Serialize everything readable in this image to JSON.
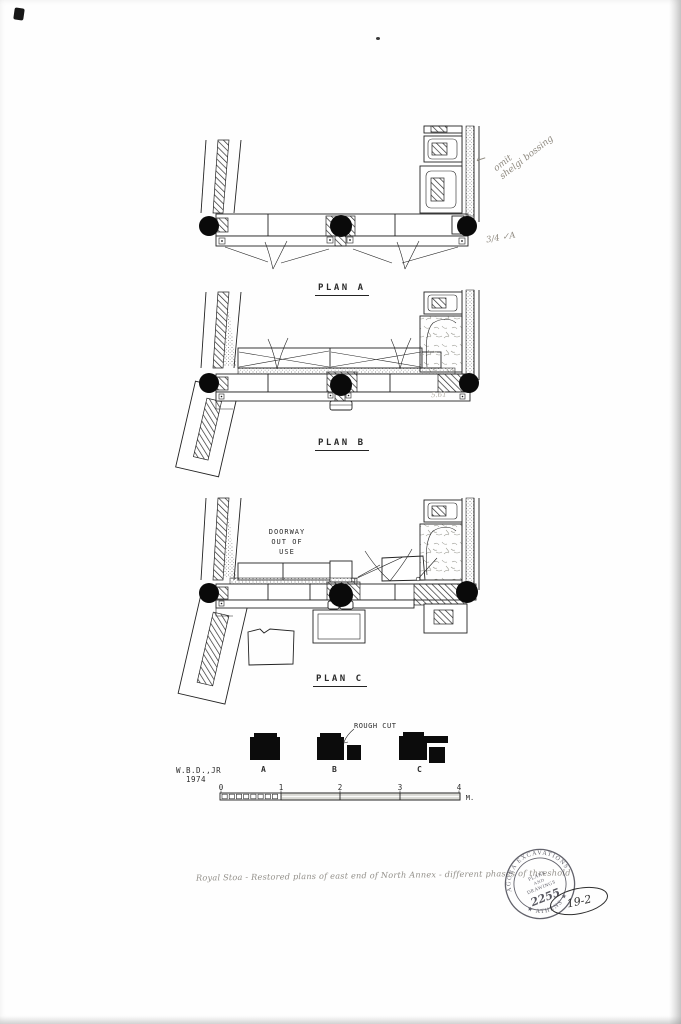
{
  "plans": {
    "a": "PLAN A",
    "b": "PLAN B",
    "c": "PLAN C"
  },
  "doorway": {
    "line1": "DOORWAY",
    "line2": "OUT OF",
    "line3": "USE"
  },
  "legend": {
    "rough_cut": "ROUGH CUT",
    "block_labels": [
      "A",
      "B",
      "C"
    ],
    "credit": "W.B.D.,JR",
    "year": "1974"
  },
  "scale": {
    "ticks": [
      "0",
      "1",
      "2",
      "3",
      "4"
    ],
    "unit": "M."
  },
  "notes": {
    "arrow": "←",
    "top_line1": "omit",
    "top_line2": "shelgi bossing",
    "check_note": "3/4  ✓A",
    "plan_b_measure": "5.61",
    "caption": "Royal Stoa - Restored plans of east end of North Annex - different phases of threshold"
  },
  "stamp": {
    "arc_top": "AGORA EXCAVATIONS",
    "arc_bottom": "★ ATHENS ★",
    "line1": "PLANS",
    "line2": "AND",
    "line3": "DRAWINGS",
    "number": "2255"
  },
  "file_number": "19-2",
  "colors": {
    "ink": "#232323",
    "pencil": "#8f8a80",
    "paper": "#fefefe",
    "stamp_ink": "#474752"
  }
}
